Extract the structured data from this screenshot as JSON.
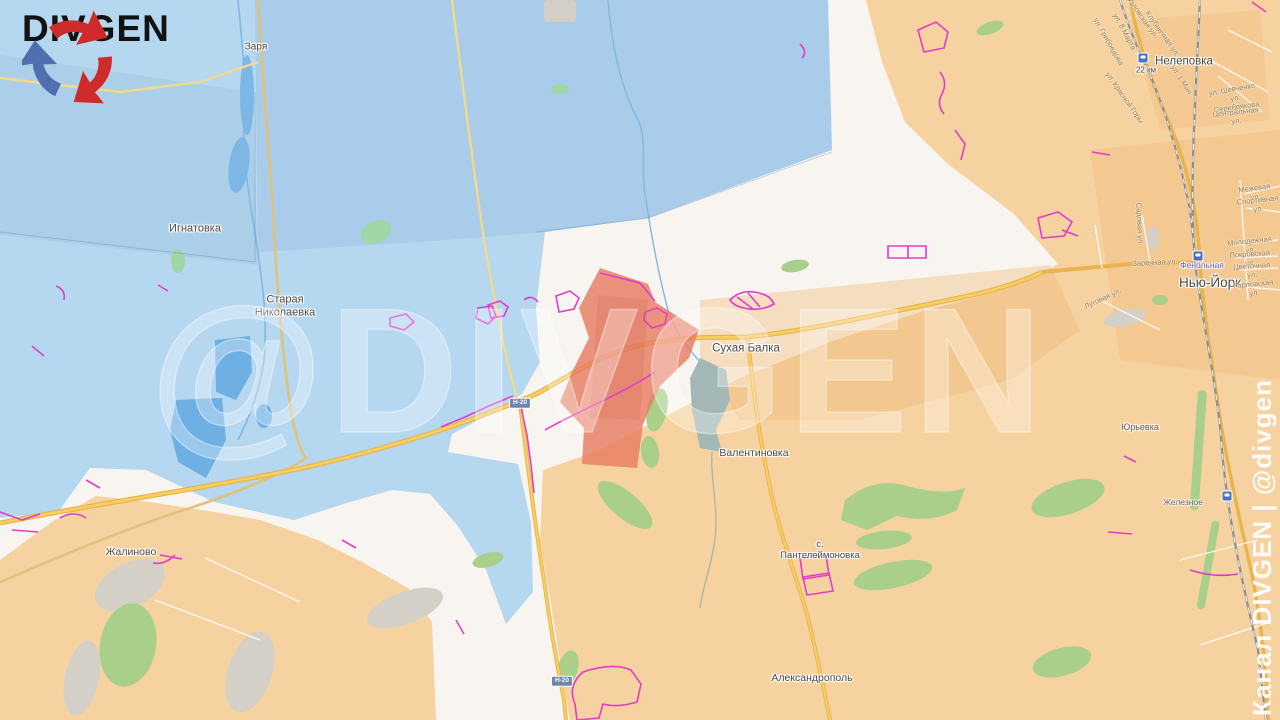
{
  "logo": {
    "text": "DIVGEN"
  },
  "watermarks": {
    "center": "@DIVGEN",
    "side": "Канал DIVGEN | @divgen"
  },
  "road_badge": "Н-20",
  "zones": {
    "friendly_color": "#b5d7ef",
    "enemy_color": "#f6d2a0",
    "contested_color": "#f8f5f1",
    "advance_color": "#e8826a",
    "fortifications_color": "#e23dc8",
    "main_road_color": "#eebb53"
  },
  "towns": {
    "zarya": "Заря",
    "ignatovka": "Игнатовка",
    "staraya_nikolaevka": "Старая\nНиколаевка",
    "sukhaya_balka": "Сухая Балка",
    "valentinovka": "Валентиновка",
    "zhalinovo": "Жалиново",
    "pantelejmonovka": "с.\nПантелеймоновка",
    "aleksandropol": "Александрополь",
    "new_york": "Нью-Йорк",
    "nelepovka": "Нелеповка",
    "yuryevka": "Юрьевка"
  },
  "stations": {
    "fenolnaya": "Фенольная",
    "zheleznoye": "Железное",
    "km22": "22 км"
  },
  "streets": {
    "zarechnaya": "Заречная ул.",
    "mezhevaya": "Межевая ул.",
    "sportivnaya": "Спортивная ул.",
    "molodezhnaya": "Молодежная ул.",
    "pokrovskaya": "Покровская ул.",
    "tsvetochnaya": "Цветочная ул.",
    "gorlovskaya": "Горловская ул.",
    "shevchenko": "ул. Шевченко",
    "serebryakova": "ул. Серебрякова",
    "tsentralnaya": "Центральная ул.",
    "marta8": "ул. 8 Марта",
    "griboedova": "ул. Грибоедова",
    "uzlovskaya": "Узловская ул.",
    "klubnichnaya": "Клубничная ул.",
    "maya1": "ул. 1 Мая",
    "krasnoy_gory": "ул. Красной Горы",
    "sadovaya": "Садовая ул.",
    "lugovaya": "Луговая ул."
  }
}
